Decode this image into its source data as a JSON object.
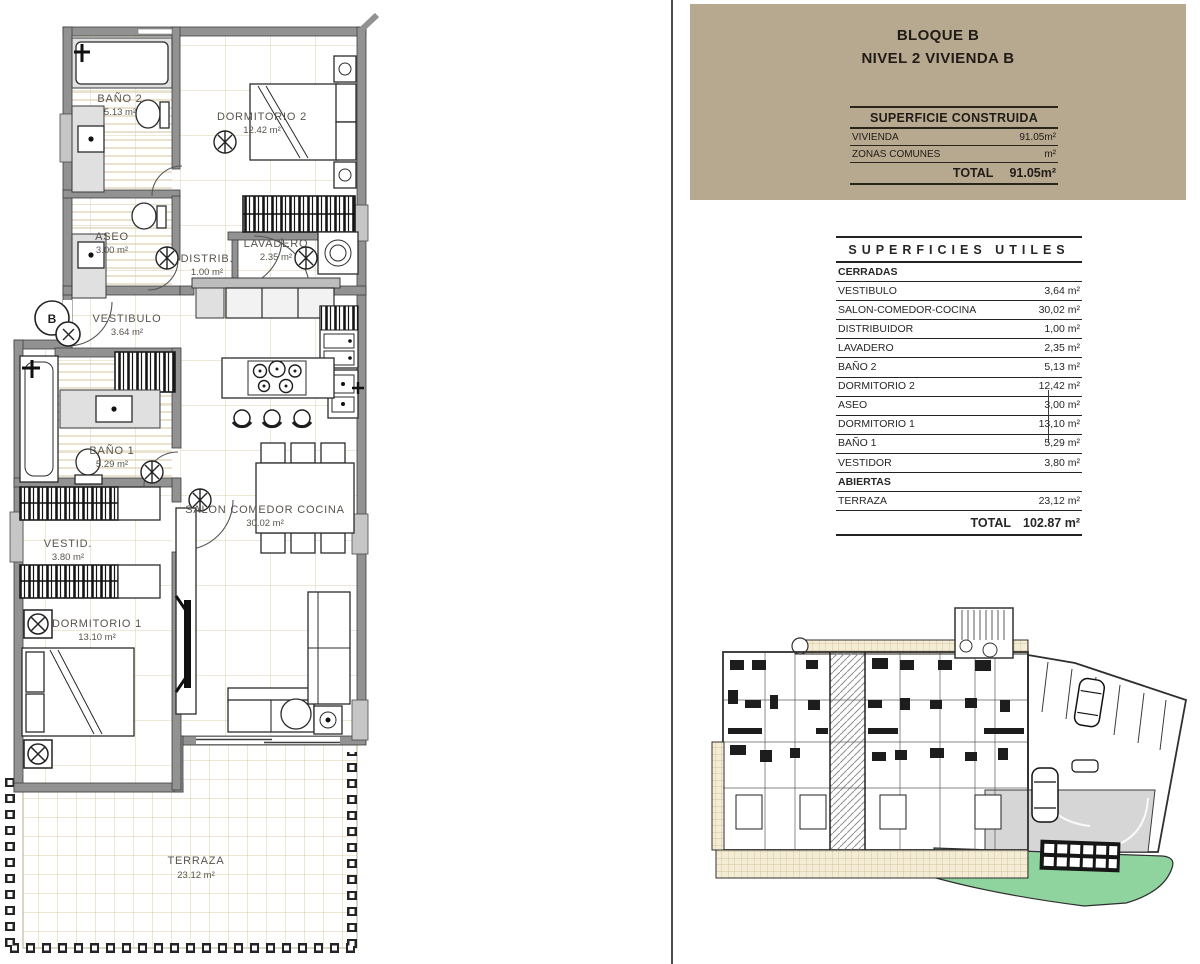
{
  "header": {
    "line1": "BLOQUE B",
    "line2": "NIVEL 2 VIVIENDA B"
  },
  "construida": {
    "title": "SUPERFICIE CONSTRUIDA",
    "rows": [
      {
        "label": "VIVIENDA",
        "value": "91.05m²"
      },
      {
        "label": "ZONAS COMUNES",
        "value": "m²"
      }
    ],
    "total_label": "TOTAL",
    "total_value": "91.05m²"
  },
  "utiles": {
    "title": "SUPERFICIES UTILES",
    "cerradas_header": "CERRADAS",
    "rows": [
      {
        "label": "VESTIBULO",
        "value": "3,64 m²"
      },
      {
        "label": "SALON-COMEDOR-COCINA",
        "value": "30,02 m²"
      },
      {
        "label": "DISTRIBUIDOR",
        "value": "1,00 m²"
      },
      {
        "label": "LAVADERO",
        "value": "2,35 m²"
      },
      {
        "label": "BAÑO 2",
        "value": "5,13 m²"
      },
      {
        "label": "DORMITORIO 2",
        "value": "12,42 m²"
      },
      {
        "label": "ASEO",
        "value": "3,00 m²"
      },
      {
        "label": "DORMITORIO 1",
        "value": "13,10 m²"
      },
      {
        "label": "BAÑO 1",
        "value": "5,29 m²"
      },
      {
        "label": "VESTIDOR",
        "value": "3,80 m²"
      }
    ],
    "abiertas_header": "ABIERTAS",
    "abiertas_rows": [
      {
        "label": "TERRAZA",
        "value": "23,12 m²"
      }
    ],
    "total_label": "TOTAL",
    "total_value": "102.87 m²"
  },
  "plan": {
    "entry_symbol": "B",
    "rooms": {
      "banio2": {
        "name": "BAÑO 2",
        "area": "5.13 m²"
      },
      "dormitorio2": {
        "name": "DORMITORIO 2",
        "area": "12.42 m²"
      },
      "aseo": {
        "name": "ASEO",
        "area": "3.00 m²"
      },
      "distribuidor": {
        "name": "DISTRIB.",
        "area": "1.00 m²"
      },
      "lavadero": {
        "name": "LAVADERO",
        "area": "2.35 m²"
      },
      "vestibulo": {
        "name": "VESTIBULO",
        "area": "3.64 m²"
      },
      "banio1": {
        "name": "BAÑO 1",
        "area": "5.29 m²"
      },
      "vestidor": {
        "name": "VESTID.",
        "area": "3.80 m²"
      },
      "dormitorio1": {
        "name": "DORMITORIO 1",
        "area": "13.10 m²"
      },
      "salon": {
        "name": "SALON COMEDOR COCINA",
        "area": "30.02 m²"
      },
      "terraza": {
        "name": "TERRAZA",
        "area": "23.12 m²"
      }
    }
  },
  "colors": {
    "header_beige": "#b7a890",
    "tile_line": "#dcd2ae",
    "wall_gray": "#929292",
    "lawn_green": "#8fd49f",
    "driveway_gray": "#d6d6d6"
  }
}
